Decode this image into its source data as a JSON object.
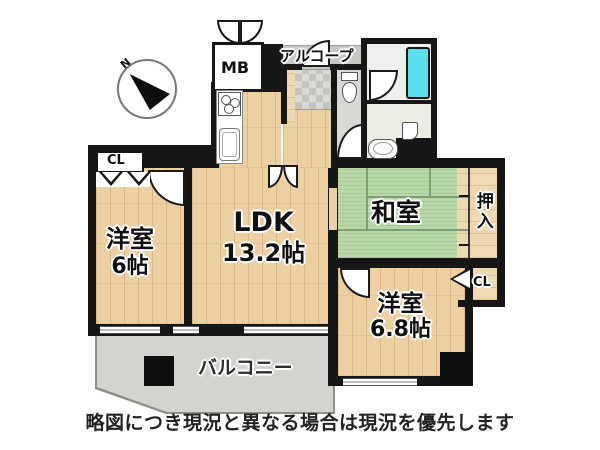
{
  "labels": {
    "compass_n": "N",
    "mb": "MB",
    "alcove": "アルコープ",
    "closet_top": "CL",
    "closet_right": "CL",
    "western1_name": "洋室",
    "western1_size": "6帖",
    "ldk_name": "LDK",
    "ldk_size": "13.2帖",
    "washitsu_name": "和室",
    "oshiire_name": "押入",
    "western2_name": "洋室",
    "western2_size": "6.8帖",
    "balcony_name": "バルコニー",
    "caption": "略図につき現況と異なる場合は現況を優先します"
  },
  "colors": {
    "wall": "#161616",
    "wood": "#ecd0a2",
    "oshiire_wood": "#eed9b0",
    "tatami": "#b9d8a8",
    "tatami_line": "#7d9f76",
    "balcony": "#d3d3cf",
    "balcony_edge": "#8f8f8a",
    "alcove": "#c7c7c3",
    "tile_light": "#dadad6",
    "tile_dark": "#c3c3bf",
    "toilet_floor": "#d8d8d4",
    "washroom_floor": "#e9ede3",
    "bath_floor": "#efefed",
    "tub": "#59dfe9"
  }
}
